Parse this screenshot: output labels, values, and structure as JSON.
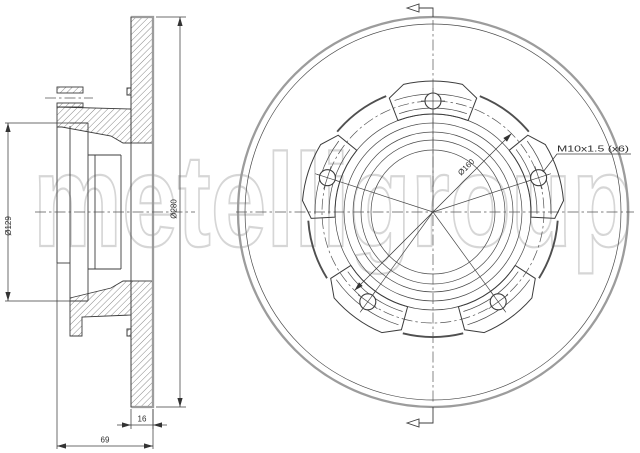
{
  "watermark": {
    "text": "metelligroup"
  },
  "views": {
    "section": {
      "dims": {
        "bore": "Ø129",
        "outer": "Ø280",
        "thickness": "16",
        "depth": "69"
      }
    },
    "front": {
      "dims": {
        "bolt_circle": "Ø160",
        "thread": "M10x1.5 (x6)"
      }
    }
  },
  "colors": {
    "background": "#ffffff",
    "line": "#3c3c3c",
    "thick_outline": "#9c9c9c",
    "watermark": "#d6d6d6"
  }
}
